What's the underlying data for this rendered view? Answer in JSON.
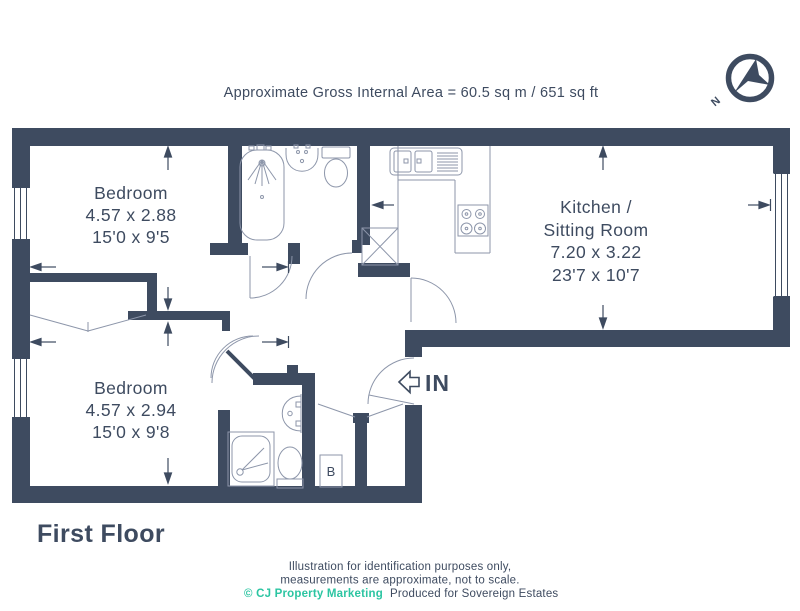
{
  "header": {
    "area_note": "Approximate Gross Internal Area = 60.5 sq m / 651 sq ft"
  },
  "compass": {
    "north_label": "N"
  },
  "rooms": {
    "bedroom_top": {
      "name": "Bedroom",
      "metric": "4.57 x 2.88",
      "imperial": "15'0 x 9'5"
    },
    "bedroom_bottom": {
      "name": "Bedroom",
      "metric": "4.57 x 2.94",
      "imperial": "15'0 x 9'8"
    },
    "kitchen_sitting": {
      "name_line1": "Kitchen /",
      "name_line2": "Sitting Room",
      "metric": "7.20 x 3.22",
      "imperial": "23'7 x 10'7"
    }
  },
  "plan_labels": {
    "entrance": "IN",
    "boiler": "B"
  },
  "floor_title": "First Floor",
  "footer": {
    "disclaimer_line1": "Illustration for identification purposes only,",
    "disclaimer_line2": "measurements are approximate, not to scale.",
    "credit_marketing": "© CJ Property Marketing",
    "credit_producer": "Produced for Sovereign Estates"
  },
  "colors": {
    "wall": "#3E4B60",
    "fixture_line": "#8D96AA",
    "accent_teal": "#2CC5A2"
  }
}
